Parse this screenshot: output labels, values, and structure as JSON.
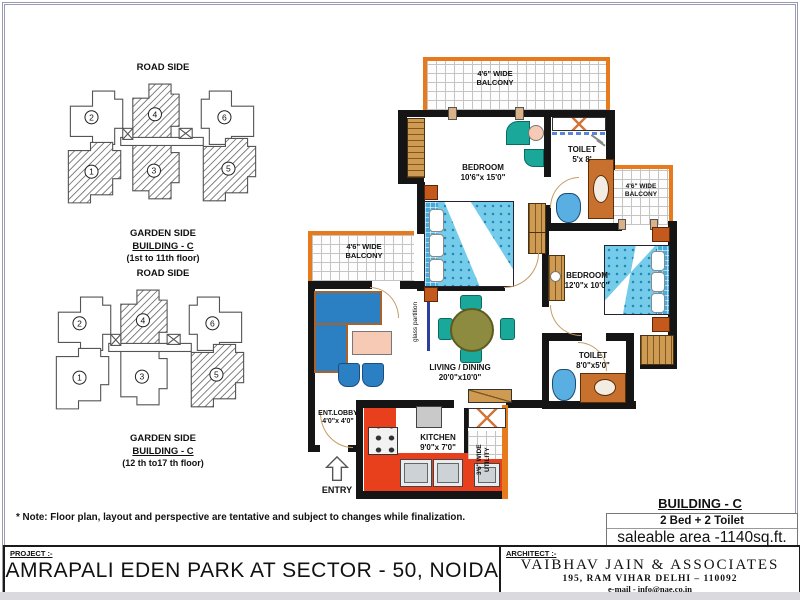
{
  "key_plans": [
    {
      "road_side": "ROAD SIDE",
      "garden_side": "GARDEN SIDE",
      "building": "BUILDING - C",
      "floors": "(1st to 11th floor)",
      "unit_labels": [
        "1",
        "2",
        "3",
        "4",
        "5",
        "6"
      ],
      "highlighted_units": [
        "1",
        "3",
        "4",
        "5"
      ]
    },
    {
      "road_side": "ROAD SIDE",
      "garden_side": "GARDEN SIDE",
      "building": "BUILDING - C",
      "floors": "(12 th to17 th floor)",
      "unit_labels": [
        "1",
        "2",
        "3",
        "4",
        "5",
        "6"
      ],
      "highlighted_units": [
        "4",
        "5"
      ]
    }
  ],
  "floor_plan": {
    "balconies": {
      "top": {
        "line1": "4'6\" WIDE",
        "line2": "BALCONY"
      },
      "left": {
        "line1": "4'6\" WIDE",
        "line2": "BALCONY"
      },
      "right": {
        "line1": "4'6\" WIDE",
        "line2": "BALCONY"
      }
    },
    "rooms": {
      "bedroom1": {
        "name": "BEDROOM",
        "size": "10'6\"x 15'0\""
      },
      "toilet1": {
        "name": "TOILET",
        "size": "5'x 8'"
      },
      "bedroom2": {
        "name": "BEDROOM",
        "size": "12'0\"x 10'0\""
      },
      "toilet2": {
        "name": "TOILET",
        "size": "8'0\"x5'0\""
      },
      "living": {
        "name": "LIVING / DINING",
        "size": "20'0\"x10'0\""
      },
      "kitchen": {
        "name": "KITCHEN",
        "size": "9'0\"x 7'0\""
      },
      "lobby": {
        "name": "ENT.LOBBY",
        "size": "4'0\"x 4'0\""
      },
      "utility": {
        "line1": "3'6\" WIDE",
        "line2": "UTILITY"
      }
    },
    "labels": {
      "entry": "ENTRY",
      "glass_partition": "glass partition"
    }
  },
  "building_info": {
    "title": "BUILDING -  C",
    "config": "2 Bed + 2 Toilet",
    "area": "saleable area -1140sq.ft."
  },
  "note": "* Note: Floor plan, layout and perspective are tentative and subject to changes while finalization.",
  "title_block": {
    "project_label": "PROJECT :-",
    "project_name": "AMRAPALI  EDEN PARK AT SECTOR - 50, NOIDA",
    "architect_label": "ARCHITECT :-",
    "architect_name": "VAIBHAV JAIN & ASSOCIATES",
    "architect_address": "195, RAM VIHAR DELHI – 110092",
    "architect_email": "e-mail - info@nae.co.in"
  },
  "colors": {
    "balcony_orange": "#e87a1e",
    "kitchen_red": "#e8401c",
    "furniture_blue": "#2b80c4",
    "bed_blue": "#74cbea",
    "teal": "#19a89a",
    "wood": "#cf9a52",
    "olive": "#8d8b40"
  }
}
